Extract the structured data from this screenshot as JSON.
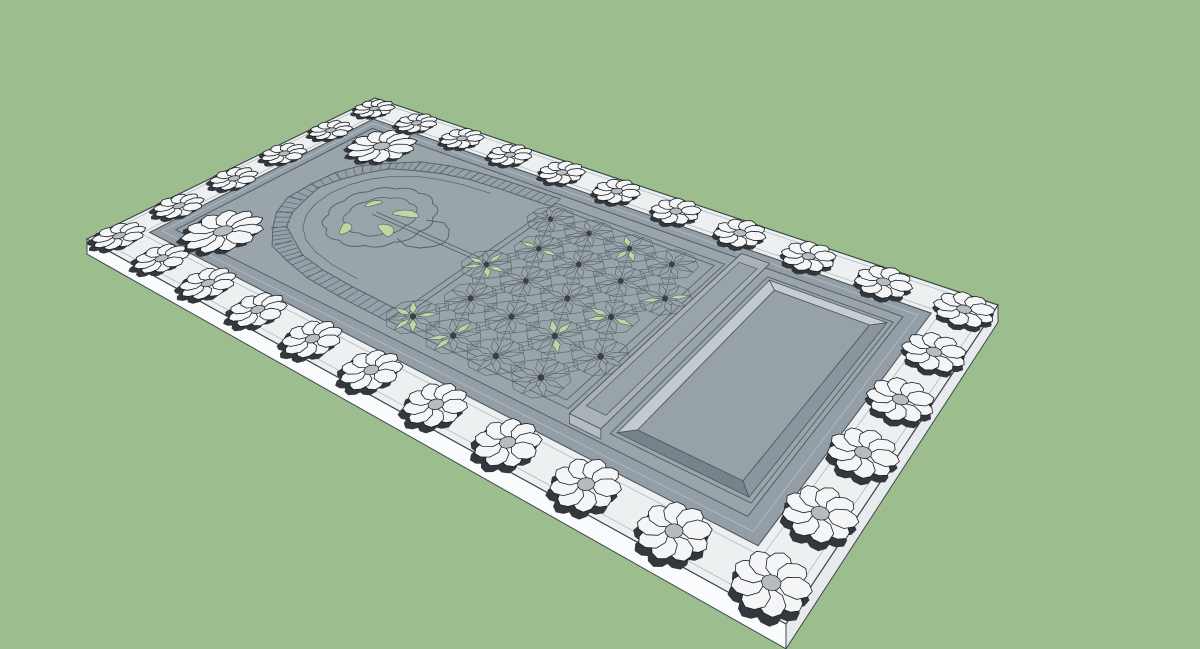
{
  "viewport": {
    "background_color": "#9cbe8f",
    "width": 1200,
    "height": 649
  },
  "model": {
    "slab": {
      "top_color": "#edf0f1",
      "skirt_front_color": "#fafbfc",
      "skirt_right_color": "#e7ebed",
      "edge_color": "#3f474d",
      "guide_line_color": "#b2b9bd",
      "guide_insets": [
        8,
        47
      ],
      "thickness": 12
    },
    "border_rosettes": {
      "petal_count": 9,
      "radius": 33,
      "petal_color": "#f3f5f6",
      "outline_color": "#1b1f23",
      "shadow_color": "#33383d",
      "center_color": "#b5bbc1",
      "positions": [
        [
          28,
          28
        ],
        [
          122,
          28
        ],
        [
          217,
          28
        ],
        [
          311,
          28
        ],
        [
          406,
          28
        ],
        [
          500,
          28
        ],
        [
          594,
          28
        ],
        [
          689,
          28
        ],
        [
          783,
          28
        ],
        [
          878,
          28
        ],
        [
          972,
          28
        ],
        [
          28,
          472
        ],
        [
          122,
          472
        ],
        [
          217,
          472
        ],
        [
          311,
          472
        ],
        [
          406,
          472
        ],
        [
          500,
          472
        ],
        [
          594,
          472
        ],
        [
          689,
          472
        ],
        [
          783,
          472
        ],
        [
          878,
          472
        ],
        [
          972,
          472
        ],
        [
          28,
          117
        ],
        [
          28,
          206
        ],
        [
          28,
          294
        ],
        [
          28,
          383
        ],
        [
          972,
          117
        ],
        [
          972,
          206
        ],
        [
          972,
          294
        ],
        [
          972,
          383
        ]
      ]
    },
    "tray": {
      "rim_outer_inset": 55,
      "rim_step_inset": 66,
      "rim_inner_inset": 78,
      "rim_color": "#939ea6",
      "rim_step_color": "#b3bac0",
      "floor_color": "#99a4ab",
      "edge_color": "#4e565d"
    },
    "niche": {
      "band_fill": "#95a0a8",
      "line_color": "#555d64",
      "half_width": 11,
      "tick_spacing": 11,
      "centerline": [
        [
          450,
          97
        ],
        [
          368,
          99
        ],
        [
          310,
          103
        ],
        [
          262,
          112
        ],
        [
          222,
          126
        ],
        [
          188,
          148
        ],
        [
          163,
          176
        ],
        [
          148,
          208
        ],
        [
          142,
          245
        ],
        [
          148,
          282
        ],
        [
          163,
          314
        ],
        [
          188,
          342
        ],
        [
          222,
          364
        ],
        [
          262,
          378
        ],
        [
          310,
          387
        ],
        [
          368,
          391
        ],
        [
          450,
          393
        ]
      ],
      "spandrel_rosettes": [
        {
          "u": 133,
          "v": 111,
          "r": 52,
          "petals": 11
        },
        {
          "u": 133,
          "v": 389,
          "r": 52,
          "petals": 11
        }
      ],
      "medallion": {
        "center": [
          278,
          250
        ],
        "outer_radius": 70,
        "outer_scallops": 12,
        "inner_radius": 45,
        "inner_scallops": 9,
        "crown": [
          [
            336,
            224
          ],
          [
            360,
            216
          ],
          [
            378,
            225
          ],
          [
            390,
            240
          ],
          [
            393,
            252
          ],
          [
            388,
            264
          ],
          [
            376,
            276
          ],
          [
            358,
            282
          ],
          [
            336,
            276
          ]
        ],
        "green_blobs": [
          {
            "c": [
              303,
              228
            ],
            "a": 19,
            "b": 8,
            "rot": -18
          },
          {
            "c": [
              309,
              270
            ],
            "a": 17,
            "b": 8,
            "rot": 22
          },
          {
            "c": [
              262,
              297
            ],
            "a": 14,
            "b": 7,
            "rot": 55
          },
          {
            "c": [
              247,
              233
            ],
            "a": 12,
            "b": 6,
            "rot": -62
          }
        ],
        "axis_lines": [
          [
            [
              266,
              246
            ],
            [
              452,
              250
            ]
          ],
          [
            [
              266,
              253
            ],
            [
              452,
              257
            ]
          ]
        ]
      },
      "green_color": "#bdd7a0"
    },
    "field": {
      "rect": [
        452,
        98,
        708,
        402
      ],
      "frame_insets": [
        0,
        9
      ],
      "line_color": "#5a626a",
      "green_color": "#bdd7a0",
      "star_radius": 30,
      "ring_radius": 32,
      "stars": [
        {
          "u": 470,
          "v": 133,
          "green": []
        },
        {
          "u": 532,
          "v": 133,
          "green": []
        },
        {
          "u": 594,
          "v": 133,
          "green": [
            1,
            2,
            5
          ]
        },
        {
          "u": 656,
          "v": 133,
          "green": []
        },
        {
          "u": 501,
          "v": 195,
          "green": [
            0,
            4
          ]
        },
        {
          "u": 563,
          "v": 195,
          "green": []
        },
        {
          "u": 625,
          "v": 195,
          "green": []
        },
        {
          "u": 687,
          "v": 195,
          "green": [
            3,
            7
          ]
        },
        {
          "u": 470,
          "v": 257,
          "green": [
            0,
            1,
            3,
            4,
            6
          ]
        },
        {
          "u": 532,
          "v": 257,
          "green": []
        },
        {
          "u": 594,
          "v": 257,
          "green": []
        },
        {
          "u": 656,
          "v": 257,
          "green": [
            0,
            3,
            4
          ]
        },
        {
          "u": 501,
          "v": 319,
          "green": []
        },
        {
          "u": 563,
          "v": 319,
          "green": []
        },
        {
          "u": 625,
          "v": 319,
          "green": [
            1,
            5,
            6
          ]
        },
        {
          "u": 687,
          "v": 319,
          "green": []
        },
        {
          "u": 470,
          "v": 381,
          "green": [
            1,
            2,
            4,
            5,
            7
          ]
        },
        {
          "u": 532,
          "v": 381,
          "green": [
            2,
            3,
            6
          ]
        },
        {
          "u": 594,
          "v": 381,
          "green": []
        },
        {
          "u": 656,
          "v": 381,
          "green": []
        }
      ]
    },
    "divider_bar": {
      "rect": [
        722,
        82,
        760,
        418
      ],
      "groove": [
        729,
        100,
        753,
        400
      ],
      "lift": 6,
      "top_color": "#a9b2b8",
      "side_color": "#919ba3",
      "end_color": "#b6bdc2",
      "groove_color": "#98a3aa"
    },
    "panel": {
      "outer_rect": [
        768,
        98,
        912,
        402
      ],
      "floor_rect": [
        782,
        112,
        898,
        388
      ],
      "frame_rect": [
        763,
        93,
        917,
        407
      ],
      "wall_far_color": "#c7ced2",
      "wall_left_color": "#c3cacf",
      "wall_near_color": "#78828a",
      "wall_right_color": "#8b959d",
      "floor_color": "#96a1a8"
    }
  }
}
